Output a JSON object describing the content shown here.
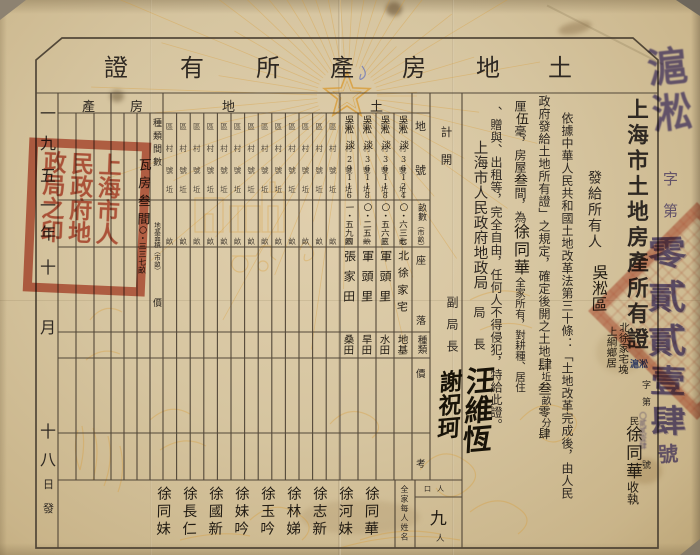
{
  "certificate": {
    "title": [
      "土",
      "地",
      "房",
      "產",
      "所",
      "有",
      "證"
    ],
    "date": {
      "chars": [
        "一",
        "九",
        "五",
        "一",
        "年",
        "十",
        "月",
        "十",
        "八"
      ],
      "small": [
        "日",
        "發"
      ]
    },
    "right": {
      "main_title": "上海市土地房產所有證",
      "serial_inline": {
        "stamp": "滬淞",
        "zi": "字",
        "di": "第",
        "digits": "〇貳貳壹肆",
        "hao": "號"
      },
      "issue": {
        "printed": "發給所有人",
        "district": "吳淞區",
        "township": "上綱鄉居",
        "hamlet": "北徐家宅堍",
        "min": "民",
        "name": "徐同華",
        "receipt": "收執"
      },
      "body_col1": "依據中華人民共和國土地改革法第三十條：「土地改革完成後，由人民",
      "body_col2": {
        "printed": "政府發給土地所有證」之規定，確定後開之土地",
        "n1": "肆",
        "u1": "坵",
        "n2": "叁",
        "u2": "畝",
        "n3": "零",
        "u3": "分",
        "n4": "肆"
      },
      "body_col3": {
        "p1": "厘",
        "h1": "伍",
        "p2": "毫，房屋",
        "h2": "叁",
        "p3": "間，為",
        "h3": "徐同華",
        "p4": "全家所有，對耕種、居住"
      },
      "body_col4": "、贈與、出租等，完全自由，任何人不得侵犯，特給此證。",
      "ji_kai": "計開",
      "agency": "上海市人民政府地政局",
      "director_label": "局長",
      "director_sig": "汪維恆",
      "deputy_label": "副局長",
      "deputy_sig": "謝祝珂"
    }
  },
  "table": {
    "section_headers": [
      "產",
      "房",
      "地",
      "土"
    ],
    "row_labels": {
      "dihao": [
        "地",
        "號"
      ],
      "mu": "畝數",
      "mu_unit": "（市畝）",
      "zuoluo": [
        "座",
        "落"
      ],
      "zhonglei": "種類",
      "jia": "價",
      "kao": "考"
    },
    "column_template": [
      "區",
      "村",
      "號",
      "坵"
    ],
    "mu_char": "畝",
    "parcels": [
      {
        "district": "吳淞",
        "village": "淡",
        "map_no": "36",
        "parcel_no": "124",
        "mu": "〇・六三七",
        "location": "北徐家宅",
        "kind": "地基"
      },
      {
        "district": "吳淞",
        "village": "淡",
        "map_no": "36",
        "parcel_no": "118",
        "mu": "〇・五六三",
        "location": "軍頭里",
        "kind": "水田"
      },
      {
        "district": "吳淞",
        "village": "淡",
        "map_no": "36",
        "parcel_no": "118",
        "mu": "〇・二五一",
        "location": "軍頭里",
        "kind": "旱田"
      },
      {
        "district": "吳淞",
        "village": "淡",
        "map_no": "29",
        "parcel_no": "116",
        "mu": "一・五九四",
        "location": "張家田",
        "kind": "桑田"
      }
    ],
    "house": {
      "type_label": "種類間數",
      "type_value": "瓦房叁間",
      "area_label": "地基面積（市畝）",
      "area_value": "〇・三三七畝",
      "jia": "價"
    },
    "population": {
      "label": "人口",
      "count": "九",
      "unit": "人"
    },
    "names_label": "全家每人姓名",
    "family_names": [
      "徐同華",
      "徐河妹",
      "徐志新",
      "徐林娣",
      "徐玉吟",
      "徐妹吟",
      "徐國新",
      "徐長仁",
      "徐同妹"
    ]
  },
  "seals": {
    "government_seal": "上海市人民政府地政局之印",
    "edge": {
      "prefix": "滬淞",
      "zi": "字",
      "di": "第",
      "digits": [
        "零",
        "貳",
        "貳",
        "壹",
        "肆"
      ],
      "hao": "號"
    }
  },
  "colors": {
    "seal_red": "#bf4f3a",
    "stamp_purple": "#5b54ad",
    "stamp_blue": "#3d55b8",
    "decor_orange": "#d9992f",
    "ink": "#2c2620",
    "paper": "#d6c5a2"
  }
}
